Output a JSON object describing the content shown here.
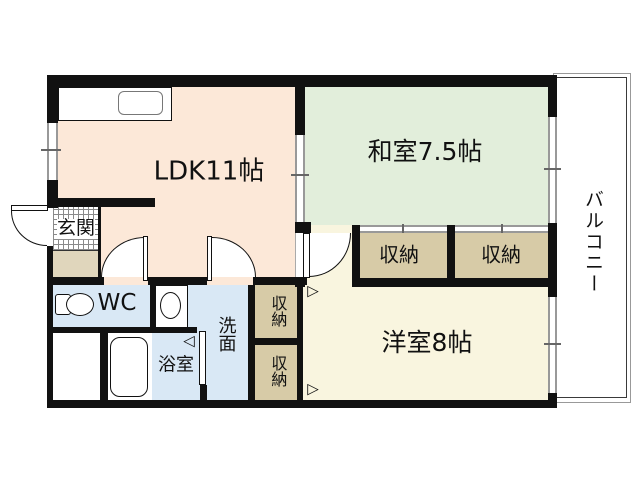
{
  "floorplan": {
    "rooms": {
      "ldk": "LDK11帖",
      "japanese_room": "和室7.5帖",
      "western_room": "洋室8帖",
      "balcony": "バルコニー",
      "entrance": "玄関",
      "toilet": "WC",
      "washroom": "洗面",
      "bathroom": "浴室",
      "closets": [
        "収納",
        "収納",
        "収納",
        "収納"
      ]
    },
    "icons": {
      "door_swing_right": "▷",
      "door_swing_left": "◁"
    },
    "colors": {
      "wall": "#111111",
      "ldk_floor": "#fce8d8",
      "japanese_room_floor": "#e2eedb",
      "western_room_floor": "#f9f5df",
      "wet_area_floor": "#d9e8f5",
      "closet_floor": "#d7cba7",
      "entrance_step": "#e0d6bc",
      "window_line": "#999999",
      "balcony_line": "#444444",
      "white": "#ffffff"
    }
  }
}
